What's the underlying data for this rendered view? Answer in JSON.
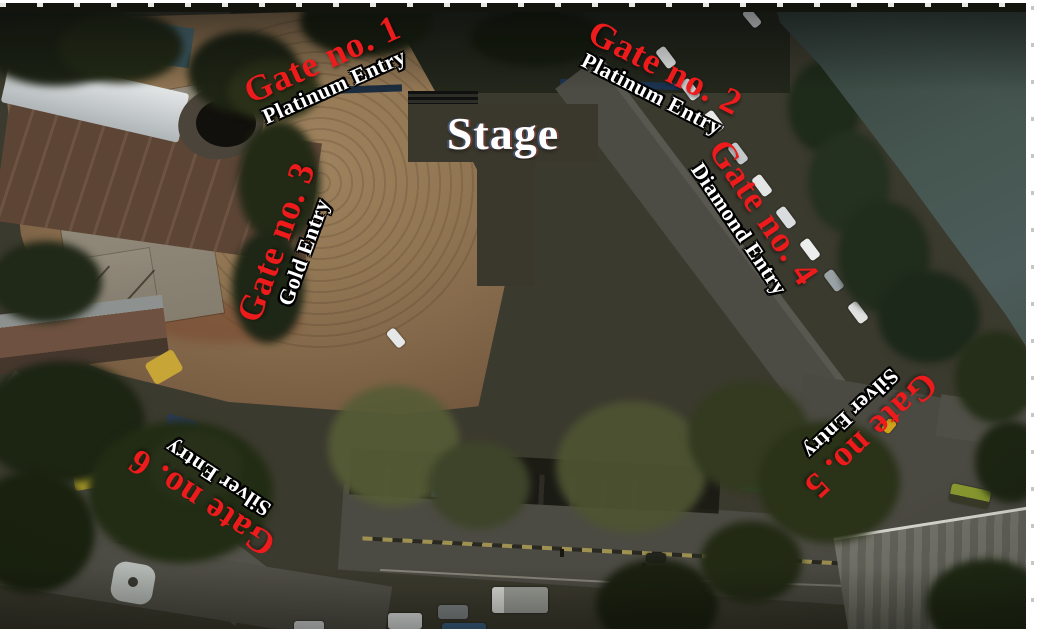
{
  "stage": {
    "label": "Stage"
  },
  "gates": [
    {
      "id": 1,
      "label": "Gate no. 1",
      "entry": "Platinum Entry"
    },
    {
      "id": 2,
      "label": "Gate no. 2",
      "entry": "Platinum Entry"
    },
    {
      "id": 3,
      "label": "Gate no. 3",
      "entry": "Gold Entry"
    },
    {
      "id": 4,
      "label": "Gate no. 4",
      "entry": "Diamond Entry"
    },
    {
      "id": 5,
      "label": "Gate no. 5",
      "entry": "Silver Entry"
    },
    {
      "id": 6,
      "label": "Gate no. 6",
      "entry": "Silver Entry"
    }
  ],
  "colors": {
    "gate_text": "#ed1b1b",
    "entry_text": "#ffffff",
    "entry_outline": "#000000",
    "stage_bg": "#3a372c",
    "stage_text": "#ffffff",
    "field": "#927754",
    "lake": "#45554f"
  }
}
